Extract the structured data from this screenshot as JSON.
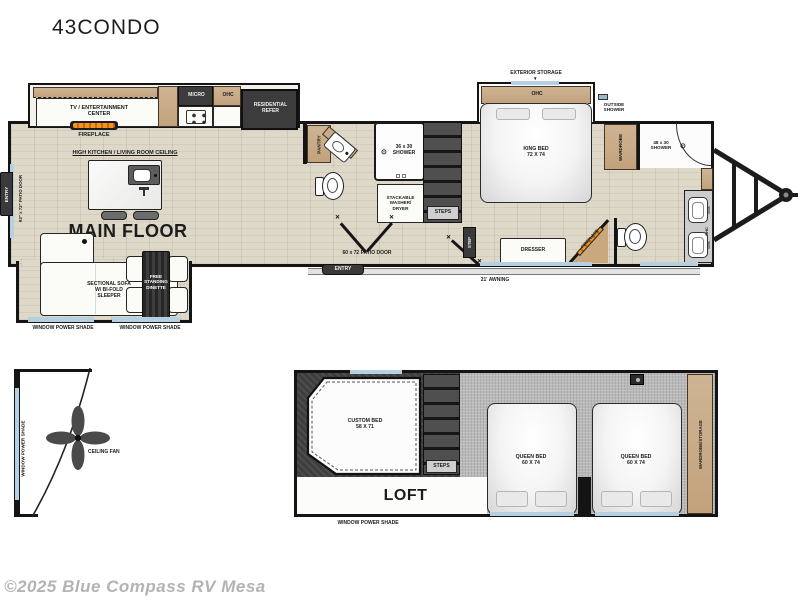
{
  "title": "43CONDO",
  "watermark": "©2025 Blue Compass RV Mesa",
  "icons": {
    "arrow_down": "▼",
    "door_x": "✕",
    "shower_head": "⊙"
  },
  "main_floor": {
    "name": "MAIN FLOOR",
    "ceiling_note": "HIGH KITCHEN / LIVING ROOM CEILING",
    "tv_center": "TV / ENTERTAINMENT\nCENTER",
    "fireplace_front": "FIREPLACE",
    "micro": "MICRO",
    "ohc_kitchen": "OHC",
    "refer": "RESIDENTIAL\nREFER",
    "pantry": "PANTRY",
    "sofa": "SECTIONAL SOFA\nW/ BI-FOLD\nSLEEPER",
    "dinette": "FREE\nSTANDING\nDINETTE",
    "shade_sofa": "WINDOW POWER SHADE",
    "shade_dinette": "WINDOW POWER SHADE",
    "entry_side": "ENTRY",
    "patio_door_side": "93\" x 72\" PATIO DOOR",
    "shower_mid": "36 x 30\nSHOWER",
    "washer": "STACKABLE\nWASHER/\nDRYER",
    "steps": "STEPS",
    "step": "STEP",
    "patio_door_main": "60 x 72 PATIO DOOR",
    "entry_main": "ENTRY",
    "awning": "21' AWNING",
    "exterior_storage": "EXTERIOR STORAGE",
    "ohc_bedroom": "OHC",
    "king_bed": "KING BED\n72 X 74",
    "outside_shower": "OUTSIDE\nSHOWER",
    "wardrobe": "WARDROBE",
    "dresser": "DRESSER",
    "fireplace_bedroom": "FIREPLACE",
    "shower_rear": "48 x 30\nSHOWER",
    "ohc_bath": "OHC",
    "sink_1": "SINK",
    "sink_2": "SINK"
  },
  "loft": {
    "name": "LOFT",
    "custom_bed": "CUSTOM BED\n58 X 71",
    "steps": "STEPS",
    "queen_bed_1": "QUEEN BED\n60 X 74",
    "queen_bed_2": "QUEEN BED\n60 X 74",
    "wardrobe_storage": "WARDROBE/STORAGE",
    "shade": "WINDOW POWER SHADE"
  },
  "front_cap": {
    "shade": "WINDOW POWER SHADE",
    "ceiling_fan": "CEILING FAN"
  },
  "colors": {
    "wall": "#141414",
    "wood_floor": "#ded8c9",
    "carpet": "#b9b9b9",
    "cabinet_tan": "#c8a985",
    "appliance_dark": "#3c3c3c",
    "window_shade_blue": "#b6d0e2",
    "flame_orange": "#ef8a1d",
    "watermark_gray": "#b3b3b3"
  }
}
